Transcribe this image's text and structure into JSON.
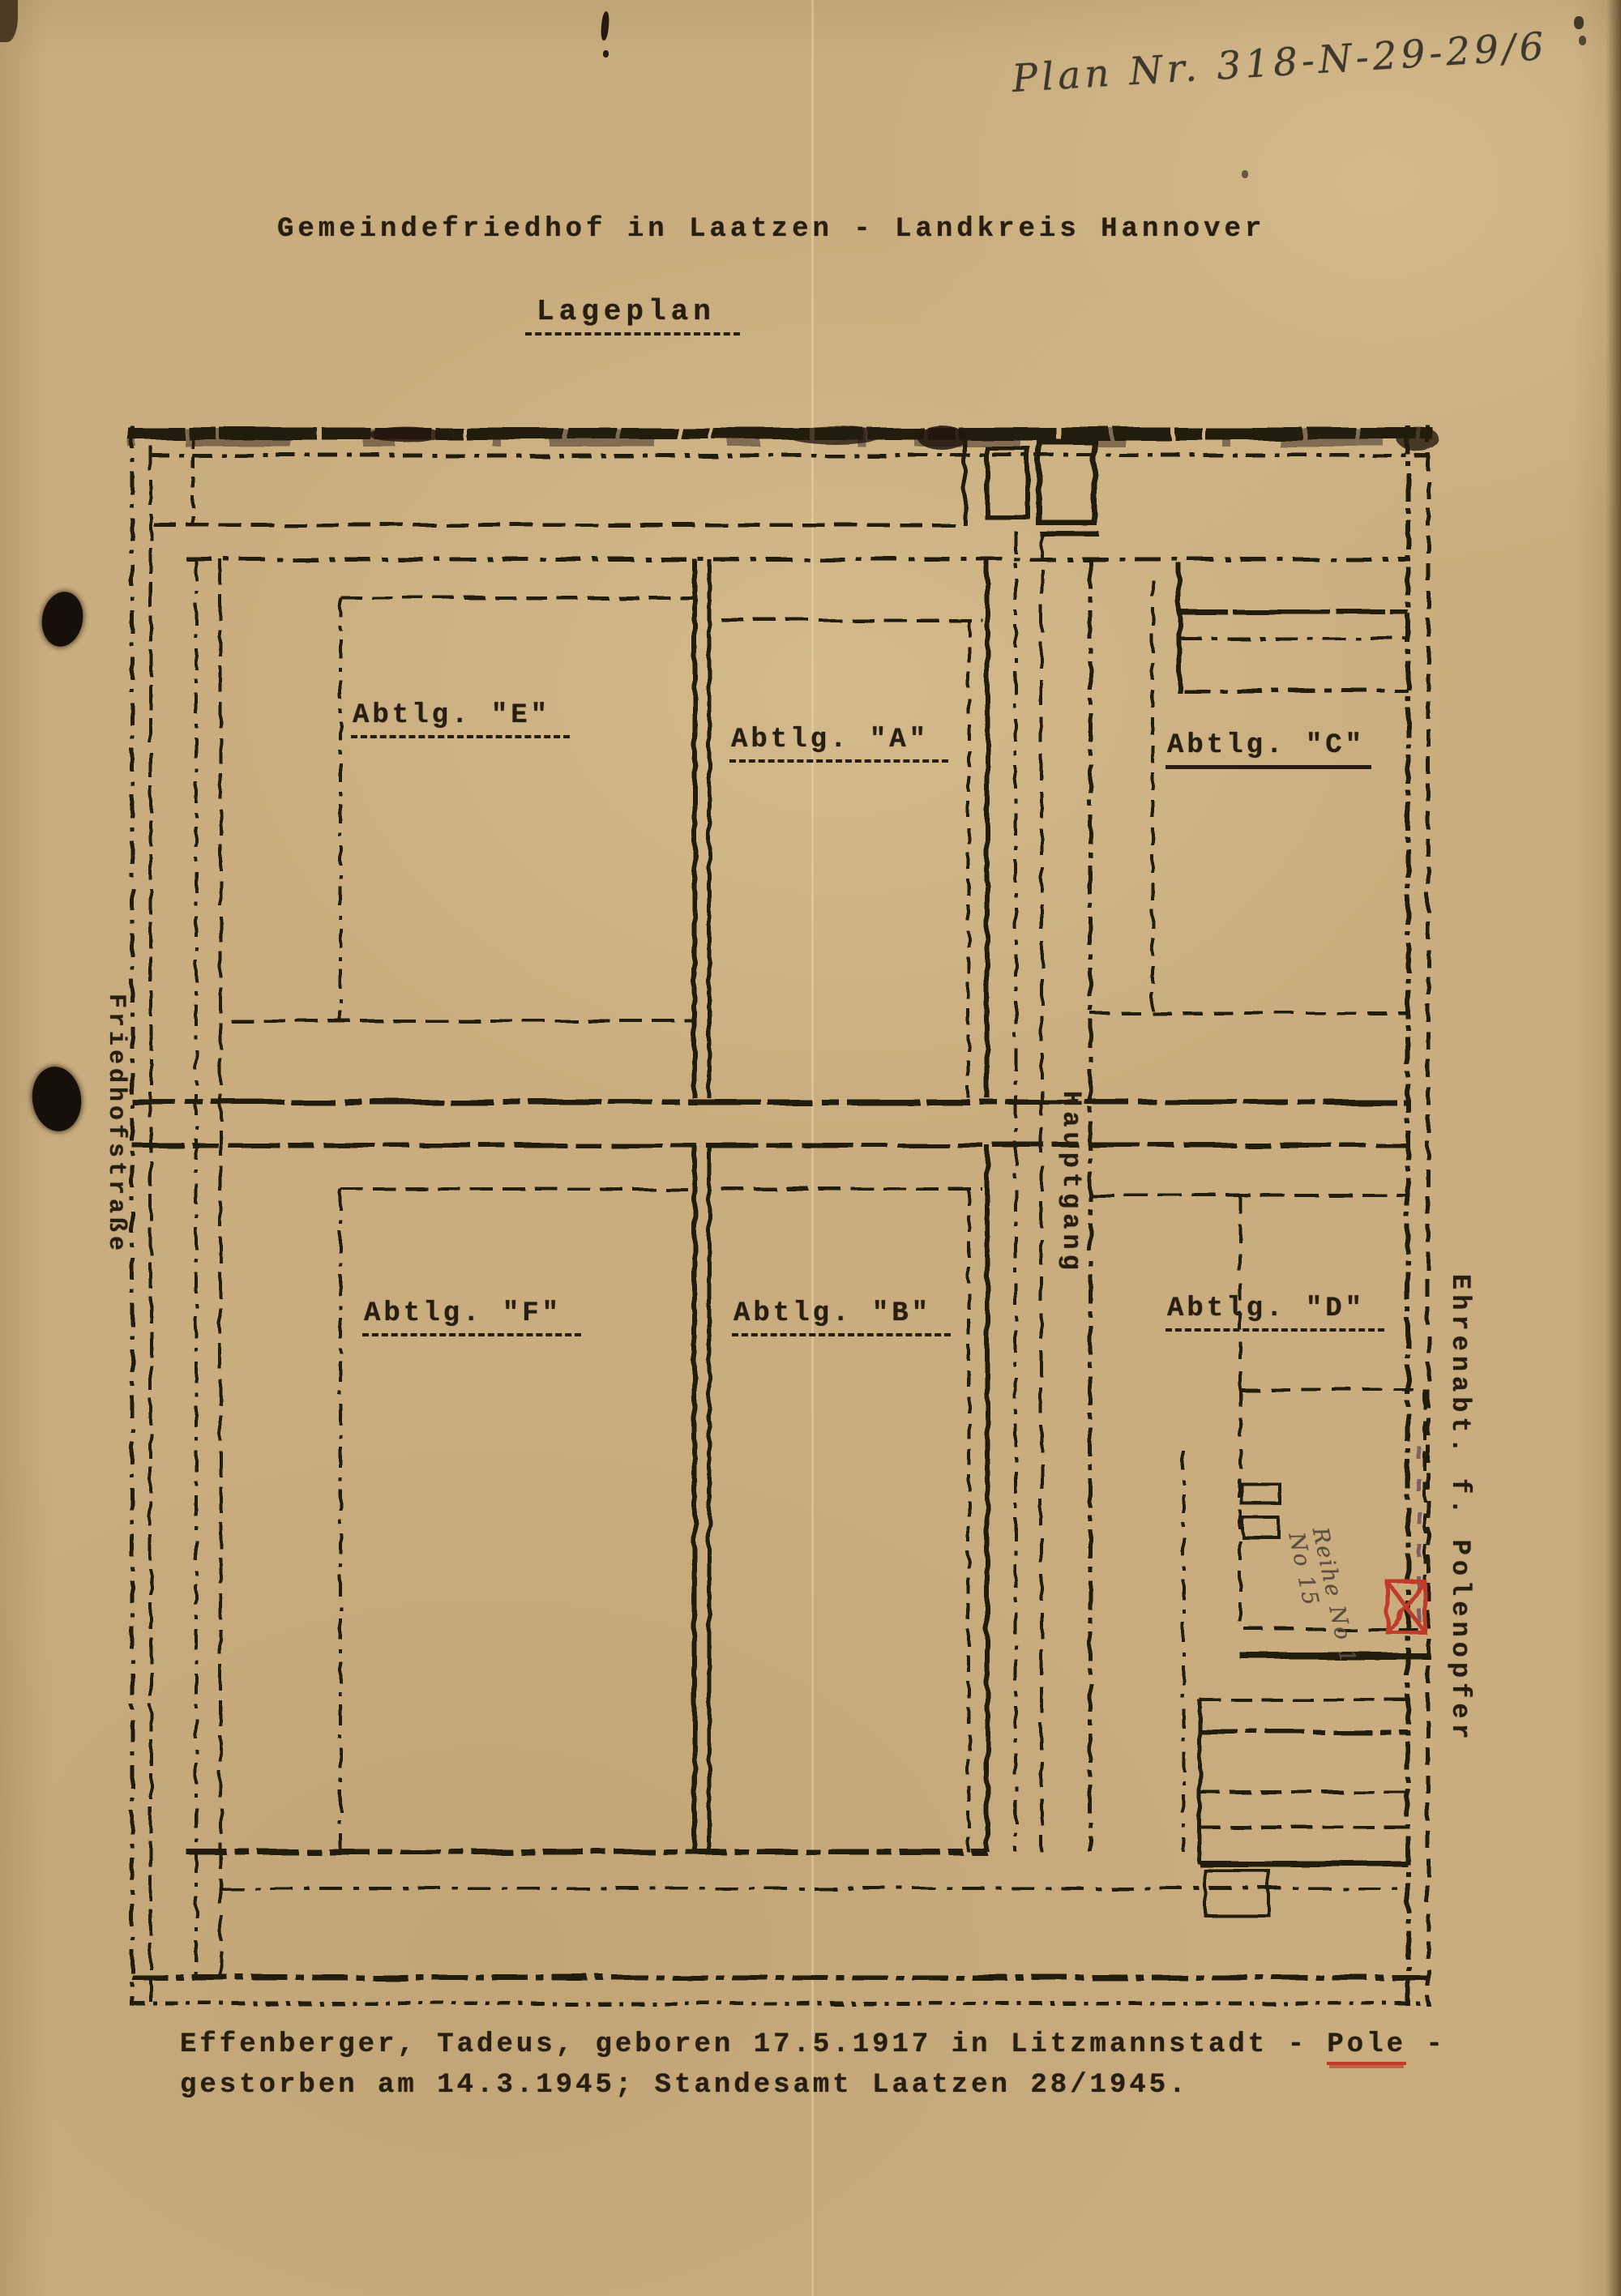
{
  "colors": {
    "paper": "#c9ad7e",
    "ink": "#241a10",
    "red": "#bf3a2b",
    "pencil": "#5a4c3e"
  },
  "header": {
    "plan_number": "Plan Nr. 318-N-29-29/6",
    "title": "Gemeindefriedhof in Laatzen - Landkreis Hannover",
    "subtitle": "Lageplan"
  },
  "plan": {
    "sections": [
      {
        "id": "E",
        "label": "Abtlg. \"E\""
      },
      {
        "id": "A",
        "label": "Abtlg. \"A\""
      },
      {
        "id": "C",
        "label": "Abtlg. \"C\""
      },
      {
        "id": "F",
        "label": "Abtlg. \"F\""
      },
      {
        "id": "B",
        "label": "Abtlg. \"B\""
      },
      {
        "id": "D",
        "label": "Abtlg. \"D\""
      }
    ],
    "main_path_label": "Hauptgang",
    "street_label": "Friedhofstraße",
    "memorial_label": "Ehrenabt. f. Polenopfer",
    "annotation": {
      "line1": "Reihe No 1",
      "line2": "No 15"
    }
  },
  "footer": {
    "line1_pre": "Effenberger, Tadeus, geboren 17.5.1917 in Litzmannstadt - ",
    "line1_highlight": "Pole",
    "line1_post": " -",
    "line2": "gestorben am 14.3.1945; Standesamt Laatzen 28/1945."
  }
}
